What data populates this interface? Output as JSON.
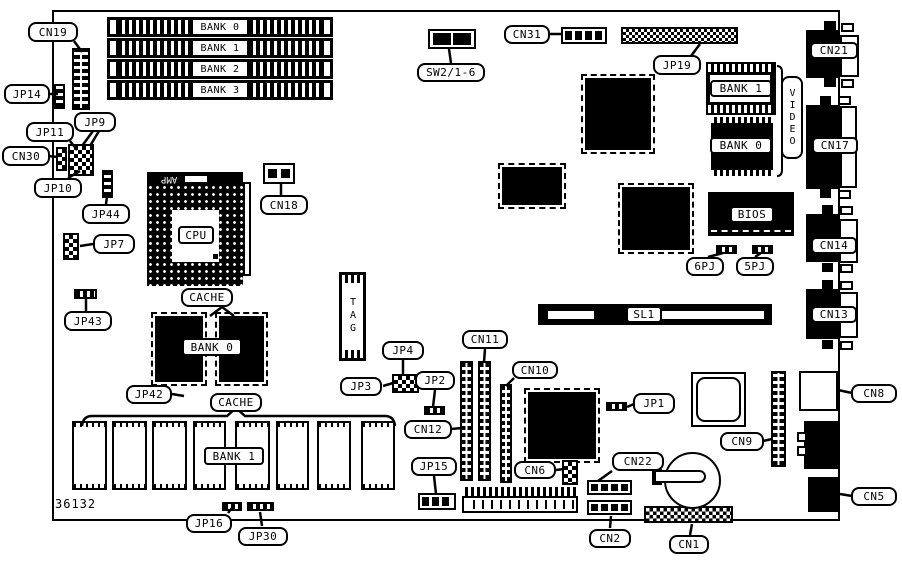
{
  "board": {
    "part_number": "36132"
  },
  "simm_banks": [
    "BANK 0",
    "BANK 1",
    "BANK 2",
    "BANK 3"
  ],
  "labels": {
    "cn19": "CN19",
    "jp14": "JP14",
    "jp11": "JP11",
    "jp9": "JP9",
    "cn30": "CN30",
    "jp10": "JP10",
    "jp44": "JP44",
    "jp7": "JP7",
    "jp43": "JP43",
    "cache": "CACHE",
    "jp42": "JP42",
    "jp16": "JP16",
    "jp30": "JP30",
    "amp": "AMP",
    "cpu": "CPU",
    "cn18": "CN18",
    "bank0": "BANK 0",
    "bank1": "BANK 1",
    "tag": "TAG",
    "jp3": "JP3",
    "jp4": "JP4",
    "jp2": "JP2",
    "cn12": "CN12",
    "cn11": "CN11",
    "cn10": "CN10",
    "jp15": "JP15",
    "cn6": "CN6",
    "sw2": "SW2/1-6",
    "cn31": "CN31",
    "jp19": "JP19",
    "video": "VIDEO",
    "bios": "BIOS",
    "pj6": "6PJ",
    "pj5": "5PJ",
    "sl1": "SL1",
    "jp1": "JP1",
    "cn9": "CN9",
    "cn8": "CN8",
    "cn5": "CN5",
    "cn22": "CN22",
    "cn2": "CN2",
    "cn1": "CN1",
    "cn21": "CN21",
    "cn17": "CN17",
    "cn14": "CN14",
    "cn13": "CN13"
  }
}
